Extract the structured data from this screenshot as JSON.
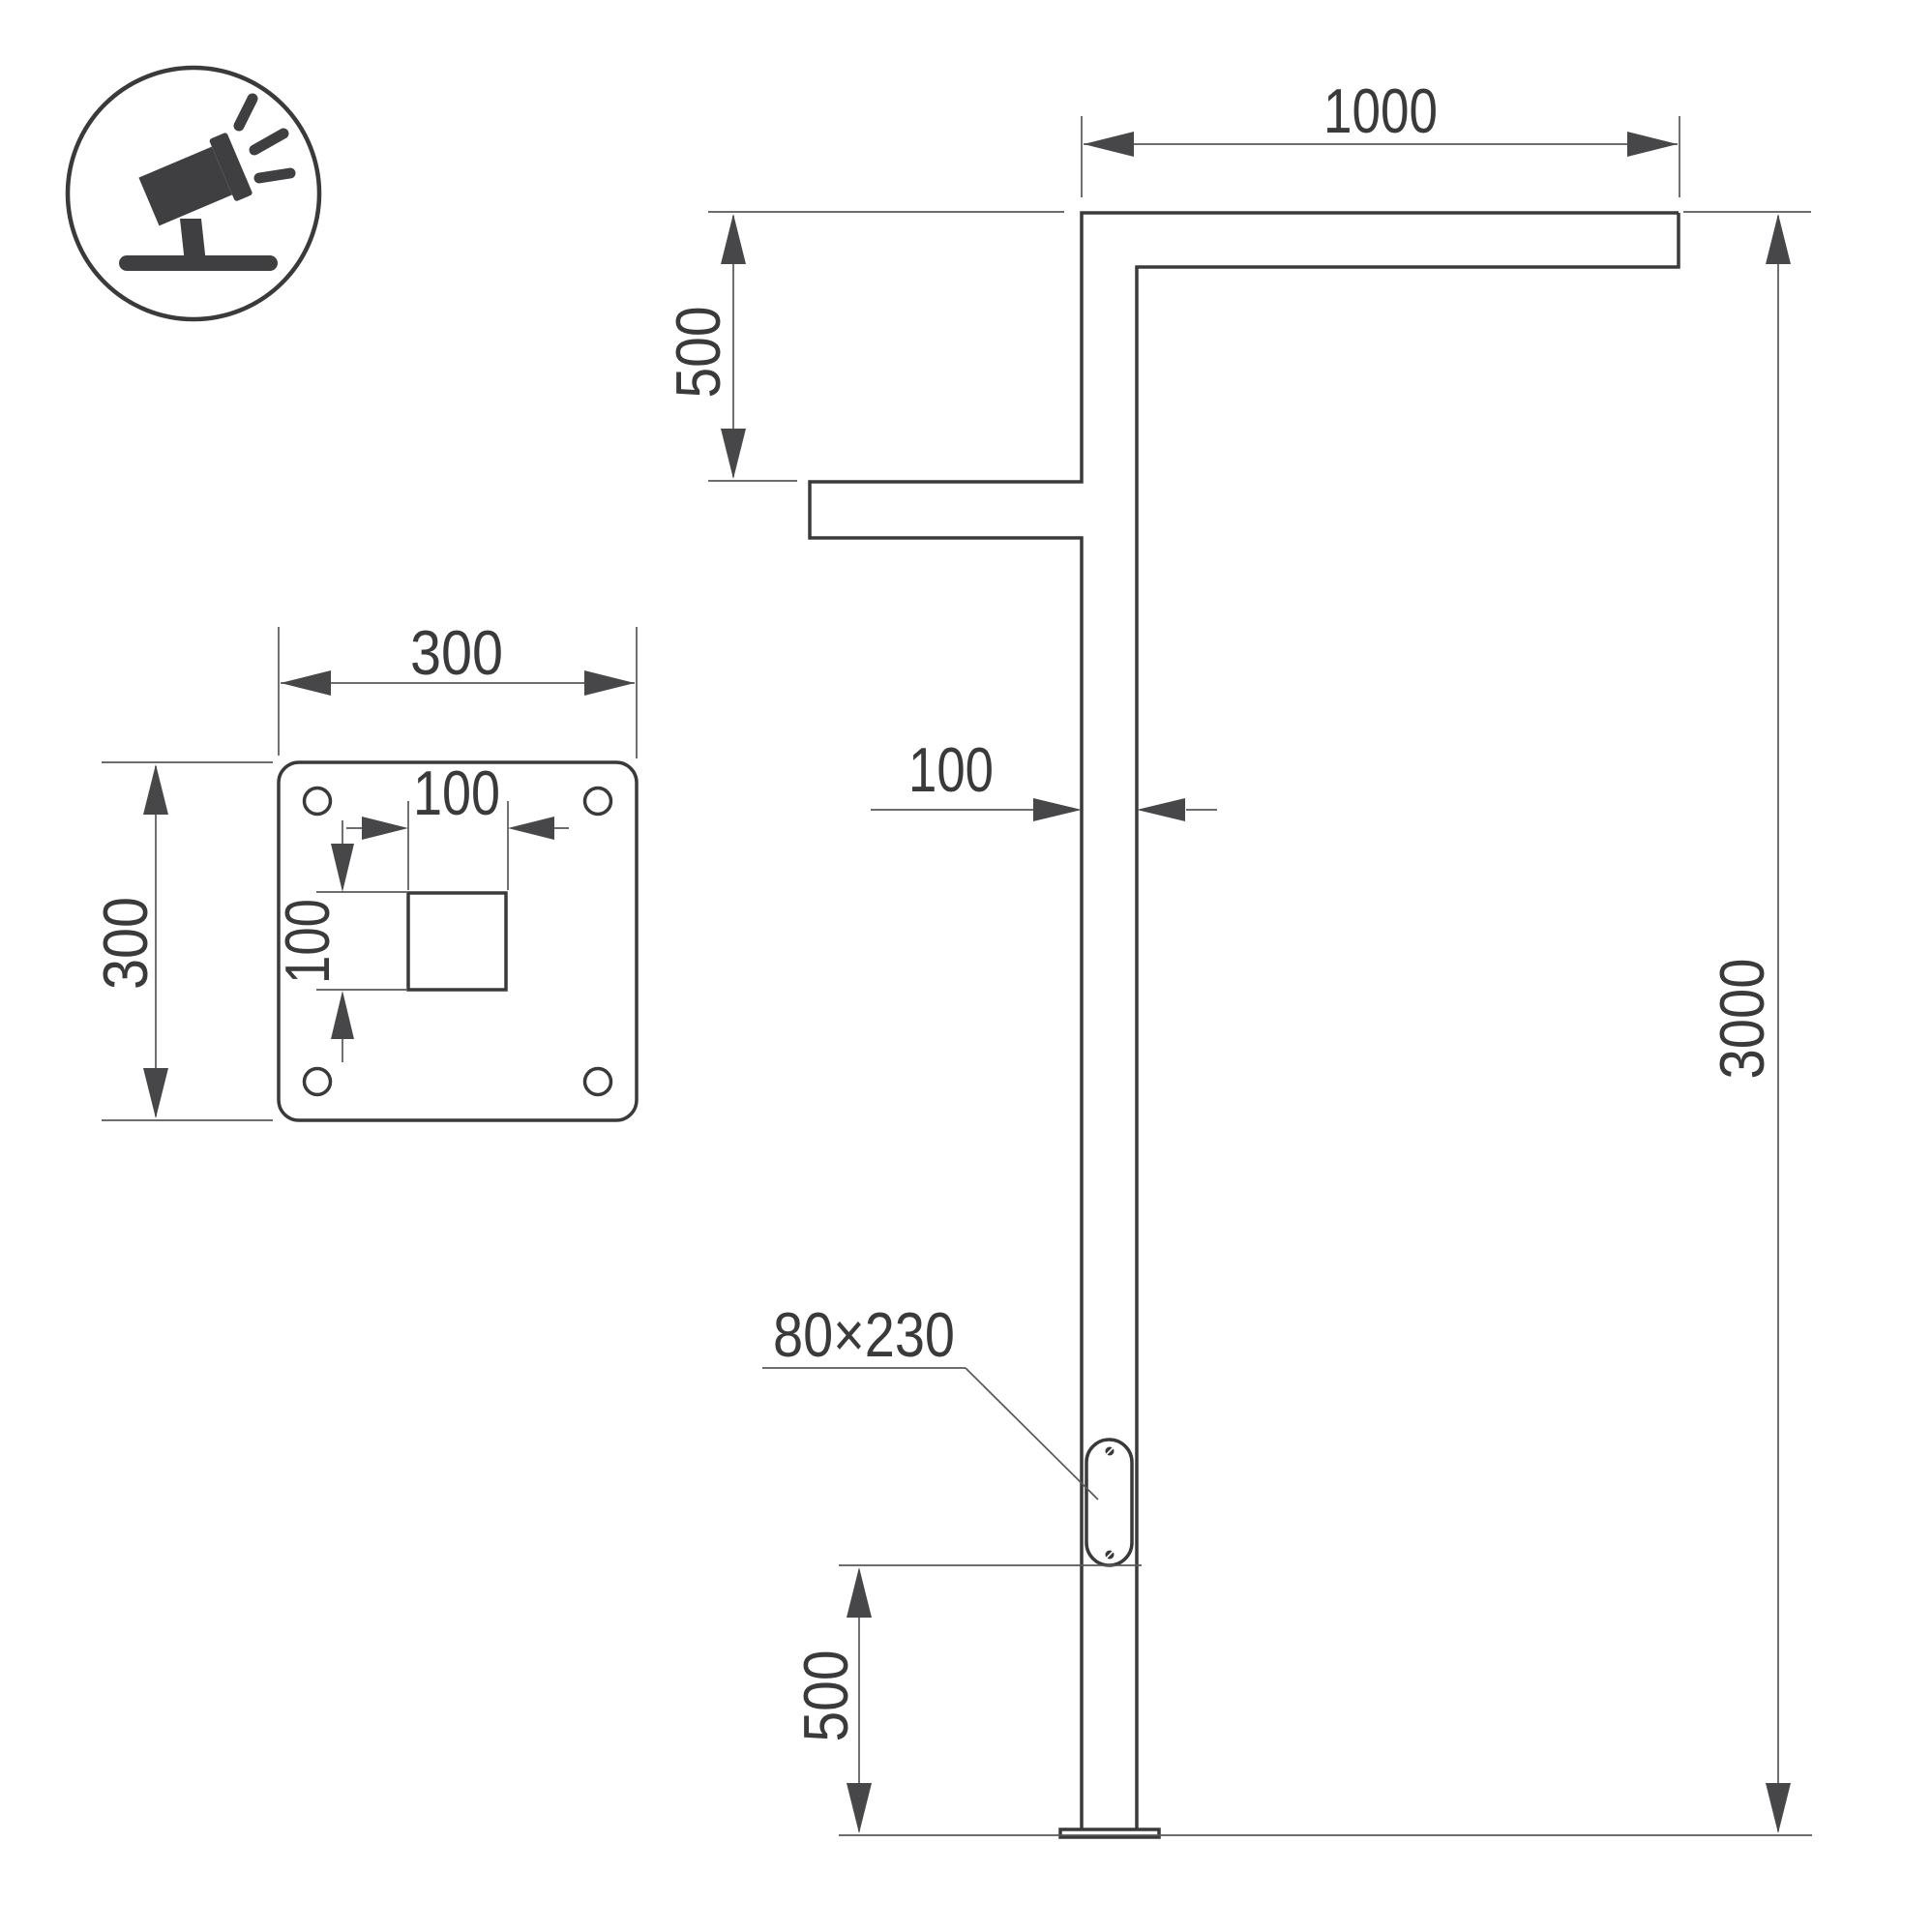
{
  "meta": {
    "drawing_type": "street-light-pole-technical-drawing"
  },
  "colors": {
    "background": "#ffffff",
    "object_line": "#3a3a3c",
    "dimension_line": "#58585b",
    "arrow_fill": "#47474a",
    "text": "#3a3a3c"
  },
  "icon": {
    "name": "tilted-floodlight-luminaire"
  },
  "side_view": {
    "arm_length": "1000",
    "arm_vertical_spacing": "500",
    "pole_section_width": "100",
    "pole_height": "3000",
    "service_door_size": "80×230",
    "service_door_height_from_base": "500"
  },
  "base_plate": {
    "plate_width": "300",
    "plate_height": "300",
    "center_hole_width": "100",
    "center_hole_height": "100"
  }
}
